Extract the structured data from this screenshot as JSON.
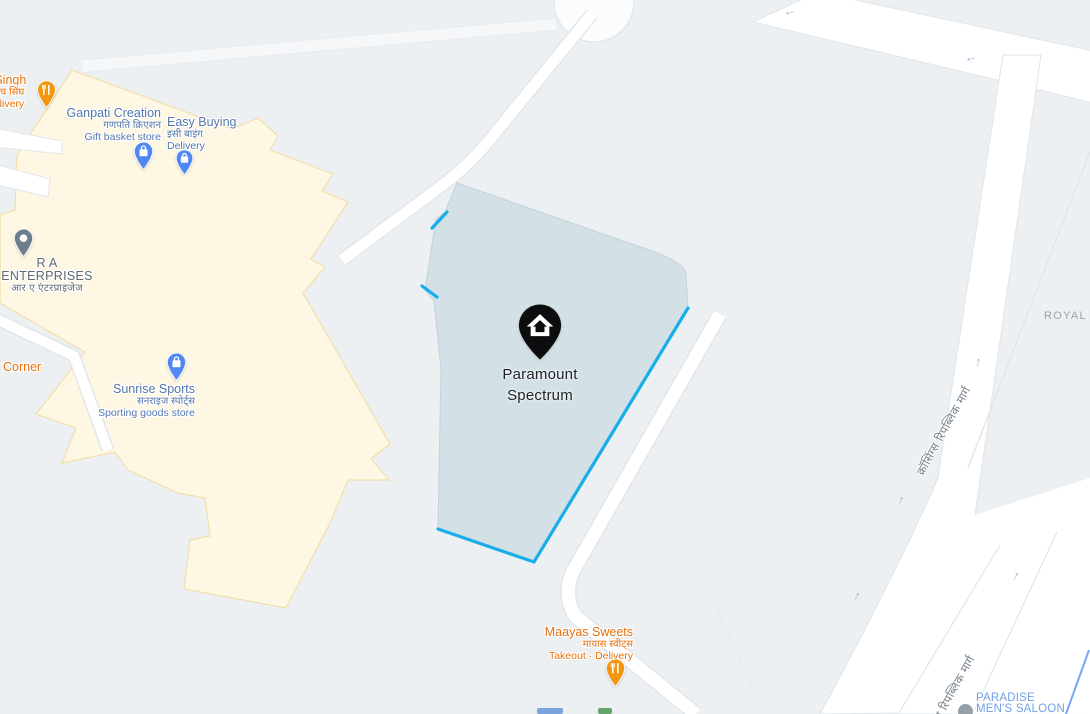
{
  "map": {
    "background": "#edf0f3",
    "road_fill": "#ffffff",
    "road_border": "#e1e5e9",
    "area_fill": "#fdf7e3",
    "area_border": "#f2dfaa"
  },
  "plot": {
    "label_line1": "Paramount",
    "label_line2": "Spectrum",
    "fill": "#d3e0e6",
    "outline_color": "#18aeea",
    "marker": "home-pin-icon"
  },
  "pois": [
    {
      "name": "ch Singh",
      "native": "सैंडविच सिंघ",
      "detail": "· Delivery",
      "category": "restaurant",
      "color": "#e8710a"
    },
    {
      "name": "Ganpati Creation",
      "native": "गणपति क्रिएशन",
      "detail": "Gift basket store",
      "category": "shopping",
      "color": "#5577ab"
    },
    {
      "name": "Easy Buying",
      "native": "इसी बाइंग",
      "detail": "Delivery",
      "category": "shopping",
      "color": "#5577ab"
    },
    {
      "name": "R A ENTERPRISES",
      "native": "आर ए एंटरप्राइजेज",
      "detail": "",
      "category": "business",
      "color": "#5d6974"
    },
    {
      "name": "Corner",
      "native": "",
      "detail": "",
      "category": "restaurant",
      "color": "#e8710a"
    },
    {
      "name": "Sunrise Sports",
      "native": "सनराइज स्पोर्ट्स",
      "detail": "Sporting goods store",
      "category": "shopping",
      "color": "#5577ab"
    },
    {
      "name": "Maayas Sweets",
      "native": "मायास स्वीट्स",
      "detail": "Takeout · Delivery",
      "category": "restaurant",
      "color": "#e8710a"
    },
    {
      "name": "PARADISE",
      "name2": "MEN'S SALOON",
      "detail": "",
      "category": "salon",
      "color": "#6ea1e6"
    }
  ],
  "road_labels": {
    "crossings_1": "क्रॉसिंग्स रिपब्लिक मार्ग",
    "crossings_2": "क्रॉसिंग्स रिपब्लिक मार्ग"
  },
  "area_labels": {
    "royal": "ROYAL M"
  },
  "glyphs": {
    "one_way_up": "↑",
    "one_way_left": "←"
  }
}
